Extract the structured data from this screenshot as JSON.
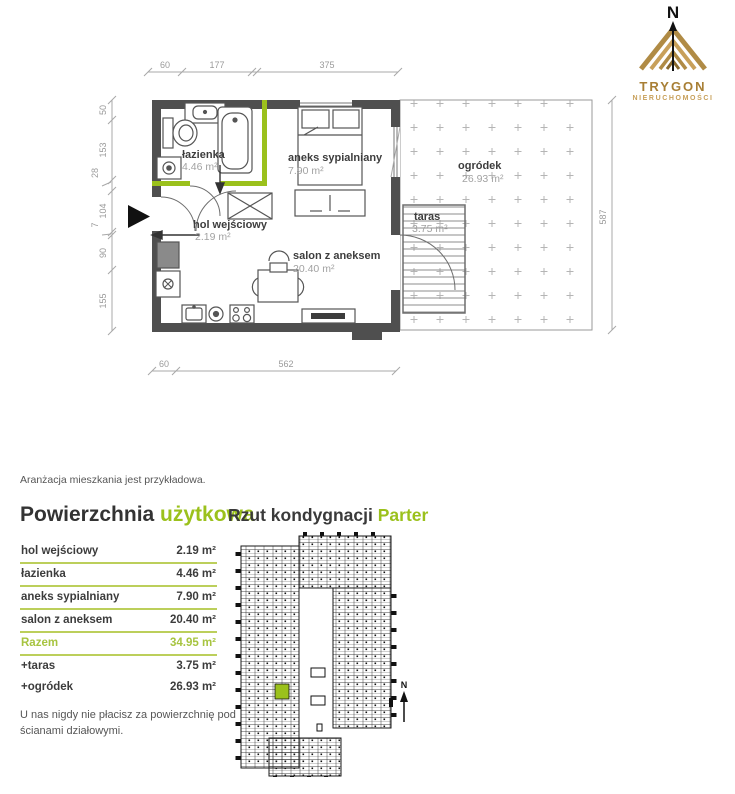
{
  "colors": {
    "accent": "#9bc11c",
    "gold": "#a87f35",
    "gold_light": "#c8a05a",
    "wall": "#4f4f4f",
    "dim": "#9a9a9a"
  },
  "logo": {
    "compass": "N",
    "brand": "TRYGON",
    "sub": "NIERUCHOMOŚCI"
  },
  "plan": {
    "rooms": [
      {
        "name": "łazienka",
        "area": "4.46 m²"
      },
      {
        "name": "aneks sypialniany",
        "area": "7.90 m²"
      },
      {
        "name": "hol wejściowy",
        "area": "2.19 m²"
      },
      {
        "name": "salon z aneksem",
        "area": "20.40 m²"
      },
      {
        "name": "taras",
        "area": "3.75 m²"
      },
      {
        "name": "ogródek",
        "area": "26.93 m²"
      }
    ],
    "dims": {
      "top": [
        "60",
        "177",
        "375"
      ],
      "left": [
        "50",
        "153",
        "28",
        "104",
        "7",
        "90",
        "155"
      ],
      "right": [
        "587"
      ],
      "bottom": [
        "60",
        "562"
      ]
    }
  },
  "note": "Aranżacja mieszkania jest przykładowa.",
  "area_table": {
    "title_main": "Powierzchnia",
    "title_accent": "użytkowa",
    "rows": [
      {
        "label": "hol wejściowy",
        "value": "2.19 m²"
      },
      {
        "label": "łazienka",
        "value": "4.46 m²"
      },
      {
        "label": "aneks sypialniany",
        "value": "7.90 m²"
      },
      {
        "label": "salon z aneksem",
        "value": "20.40 m²"
      },
      {
        "label": "Razem",
        "value": "34.95 m²"
      },
      {
        "label": "+taras",
        "value": "3.75 m²"
      },
      {
        "label": "+ogródek",
        "value": "26.93 m²"
      }
    ]
  },
  "floor_section": {
    "title": "Rzut kondygnacji",
    "highlight": "Parter",
    "compass": "N"
  },
  "footer_note": "U nas nigdy nie płacisz za powierzchnię pod ścianami działowymi."
}
